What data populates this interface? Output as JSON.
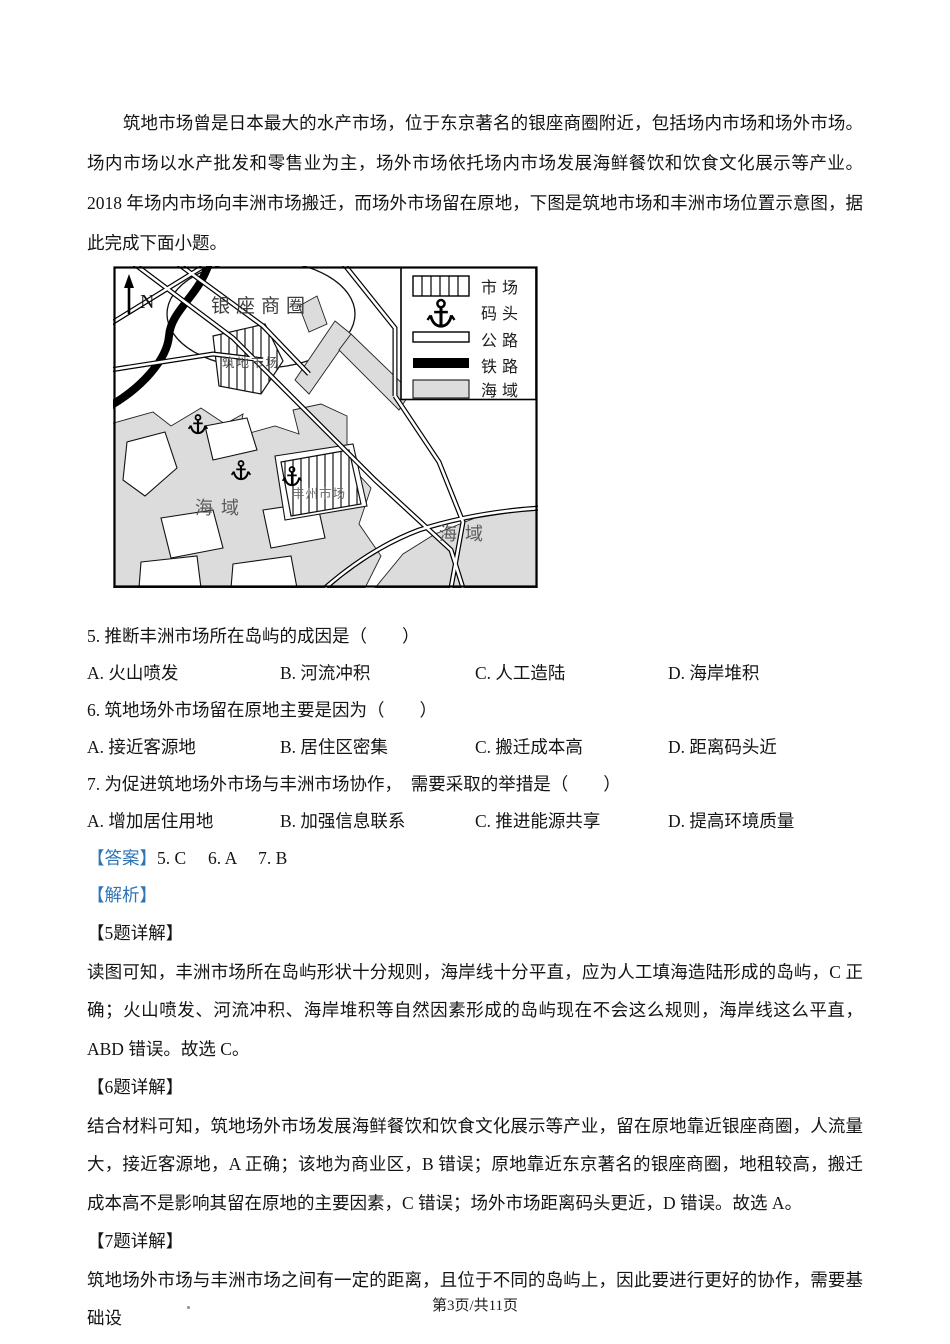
{
  "intro": "筑地市场曾是日本最大的水产市场，位于东京著名的银座商圈附近，包括场内市场和场外市场。场内市场以水产批发和零售业为主，场外市场依托场内市场发展海鲜餐饮和饮食文化展示等产业。2018 年场内市场向丰洲市场搬迁，而场外市场留在原地，下图是筑地市场和丰洲市场位置示意图，据此完成下面小题。",
  "map": {
    "north": "N",
    "ginza": "银座商圈",
    "tsukiji": "筑地市场",
    "toyosu": "丰州市场",
    "sea_left": "海域",
    "sea_right": "海域",
    "legend": [
      "市场",
      "码头",
      "公路",
      "铁路",
      "海域"
    ],
    "colors": {
      "sea": "#dcdcdc",
      "ink": "#000000"
    }
  },
  "questions": [
    {
      "stem": "5. 推断丰洲市场所在岛屿的成因是（　　）",
      "options": [
        "A. 火山喷发",
        "B. 河流冲积",
        "C. 人工造陆",
        "D. 海岸堆积"
      ]
    },
    {
      "stem": "6. 筑地场外市场留在原地主要是因为（　　）",
      "options": [
        "A. 接近客源地",
        "B. 居住区密集",
        "C. 搬迁成本高",
        "D. 距离码头近"
      ]
    },
    {
      "stem": "7. 为促进筑地场外市场与丰洲市场协作，　需要采取的举措是（　　）",
      "options": [
        "A. 增加居住用地",
        "B. 加强信息联系",
        "C. 推进能源共享",
        "D. 提高环境质量"
      ]
    }
  ],
  "answer": {
    "label": "【答案】",
    "text": "5. C　 6. A　 7. B"
  },
  "analysis": {
    "label": "【解析】"
  },
  "explanations": [
    {
      "title": "【5题详解】",
      "body": "读图可知，丰洲市场所在岛屿形状十分规则，海岸线十分平直，应为人工填海造陆形成的岛屿，C 正确；火山喷发、河流冲积、海岸堆积等自然因素形成的岛屿现在不会这么规则，海岸线这么平直，ABD 错误。故选 C。"
    },
    {
      "title": "【6题详解】",
      "body": "结合材料可知，筑地场外市场发展海鲜餐饮和饮食文化展示等产业，留在原地靠近银座商圈，人流量大，接近客源地，A 正确；该地为商业区，B 错误；原地靠近东京著名的银座商圈，地租较高，搬迁成本高不是影响其留在原地的主要因素，C 错误；场外市场距离码头更近，D 错误。故选 A。"
    },
    {
      "title": "【7题详解】",
      "body": "筑地场外市场与丰洲市场之间有一定的距离，且位于不同的岛屿上，因此要进行更好的协作，需要基础设"
    }
  ],
  "footer": "第3页/共11页",
  "accent_blue": "#2E75B6"
}
